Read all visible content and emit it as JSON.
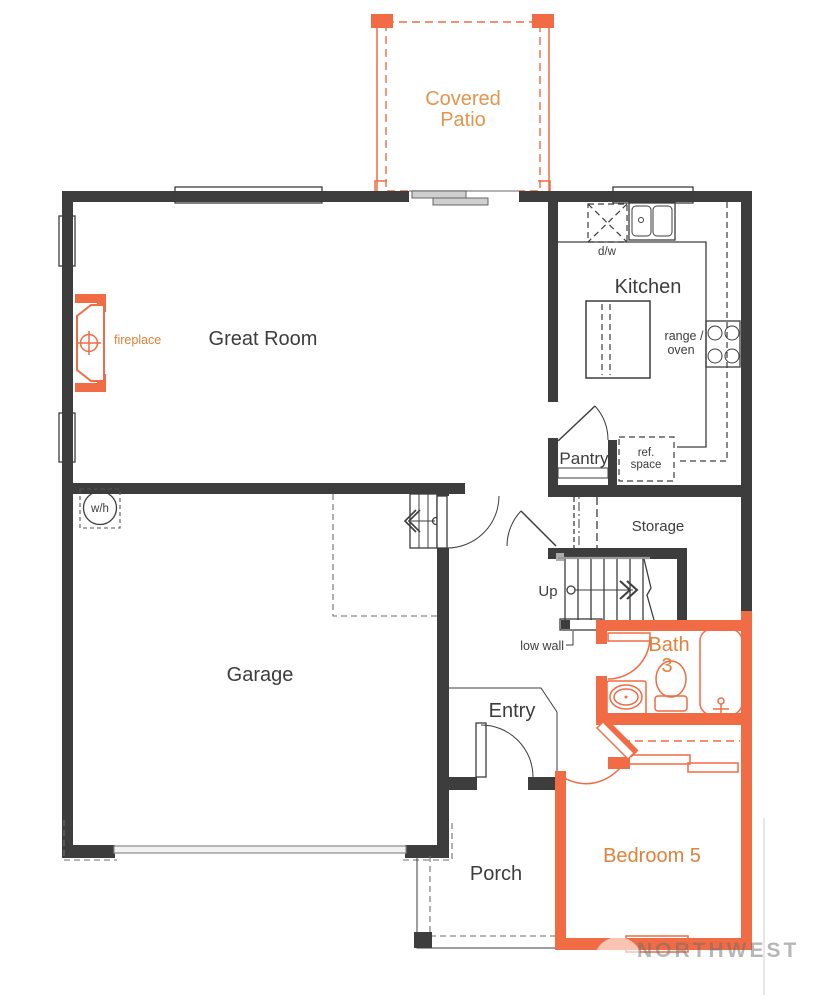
{
  "rooms": {
    "covered_patio_line1": "Covered",
    "covered_patio_line2": "Patio",
    "great_room": "Great Room",
    "kitchen": "Kitchen",
    "pantry": "Pantry",
    "storage": "Storage",
    "garage": "Garage",
    "entry": "Entry",
    "porch": "Porch",
    "bath_line1": "Bath",
    "bath_line2": "3",
    "bedroom": "Bedroom 5"
  },
  "labels": {
    "fireplace": "fireplace",
    "water_heater": "w/h",
    "dishwasher": "d/w",
    "range_line1": "range /",
    "range_line2": "oven",
    "ref_line1": "ref.",
    "ref_line2": "space",
    "up": "Up",
    "low_wall": "low wall"
  },
  "watermark": "NORTHWEST",
  "colors": {
    "wall": "#3d3d3d",
    "accent_wall": "#f16b44",
    "accent_text": "#e0823c",
    "accent_text_light": "#e6954e",
    "gray_line": "#9a9a9a"
  }
}
